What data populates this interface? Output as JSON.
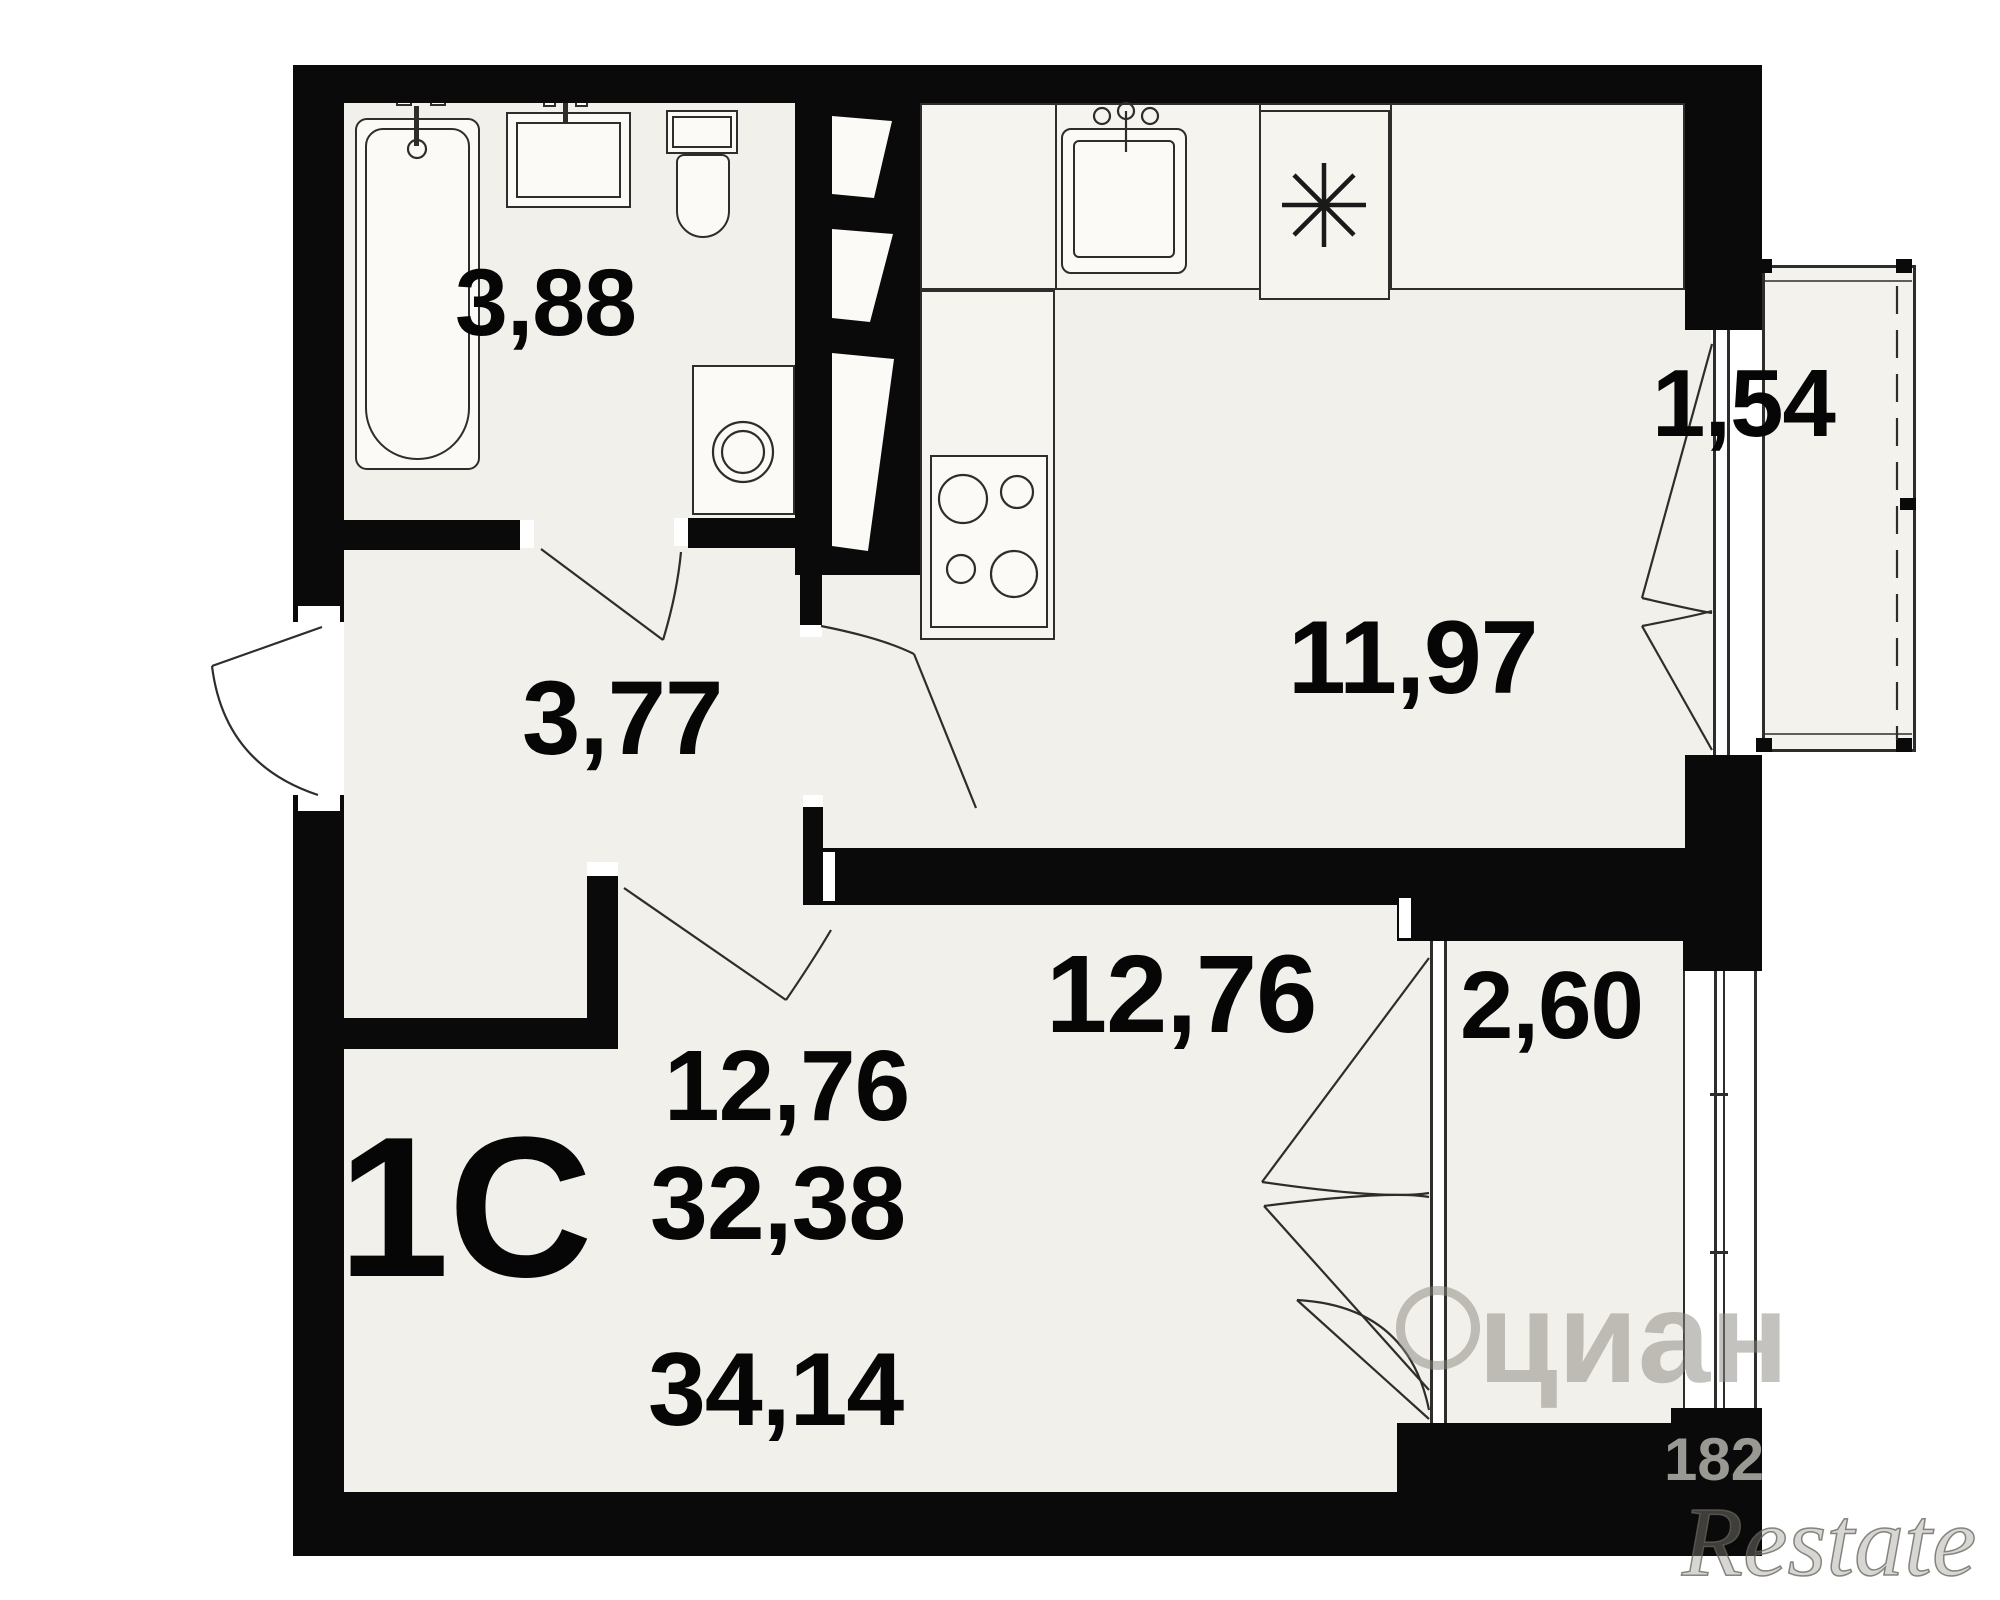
{
  "floorplan": {
    "rooms": {
      "bathroom": {
        "name": "bathroom",
        "area": "3,88"
      },
      "hallway": {
        "name": "hallway",
        "area": "3,77"
      },
      "kitchen": {
        "name": "kitchen",
        "area": "11,97"
      },
      "living_room": {
        "name": "living-room",
        "area": "12,76"
      },
      "balcony_top": {
        "name": "balcony-top",
        "area": "1,54"
      },
      "balcony_bottom": {
        "name": "balcony-bottom",
        "area": "2,60"
      }
    },
    "summary": {
      "unit_label": "1С",
      "living": "12,76",
      "area_main": "32,38",
      "area_total": "34,14"
    },
    "watermarks": {
      "brand": "циан",
      "digits": "182",
      "agency": "Restate"
    },
    "icons": [
      "bathtub",
      "bath-sink",
      "toilet",
      "washing-machine",
      "kitchen-sink",
      "stove-burners",
      "appliance-asterisk",
      "vent-shaft-wedges",
      "door-swing-arcs",
      "balcony-glazing"
    ],
    "colors": {
      "wall": "#0a0a0a",
      "floor": "#f2f0ea",
      "line": "#2e2d2b",
      "fixture": "#fbfaf7",
      "watermark_grey": "#87857d"
    }
  }
}
